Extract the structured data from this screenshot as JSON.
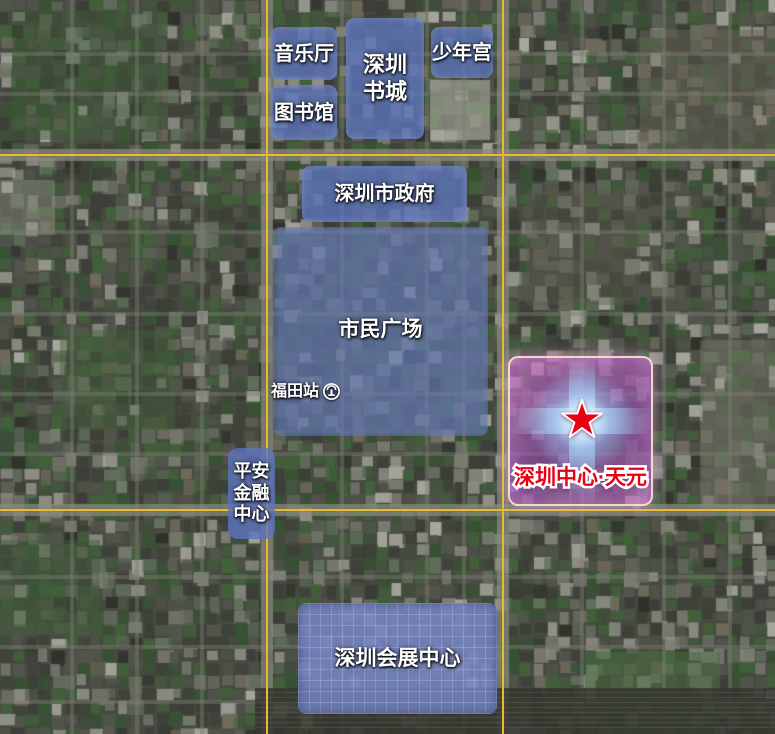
{
  "map": {
    "title": "深圳中心区域卫星示意图",
    "pois": {
      "concert_hall": "音乐厅",
      "library": "图书馆",
      "book_city": "深圳书城",
      "children_palace": "少年宫",
      "city_government": "深圳市政府",
      "civic_square": "市民广场",
      "futian_station": "福田站",
      "pingan_finance_center": "平安金融中心",
      "convention_center": "深圳会展中心",
      "project": "深圳中心·天元"
    },
    "icons": {
      "futian_station": "railway-station-icon",
      "project_marker": "red-star-icon"
    },
    "colors": {
      "grid_line": "#e6bd32",
      "poi_overlay_blue": "#5c73be",
      "project_overlay_pink": "#b85cc0",
      "project_border": "#f8e0ca",
      "project_text_red": "#e60012",
      "star_red": "#e60012",
      "label_text": "#ffffff"
    }
  }
}
